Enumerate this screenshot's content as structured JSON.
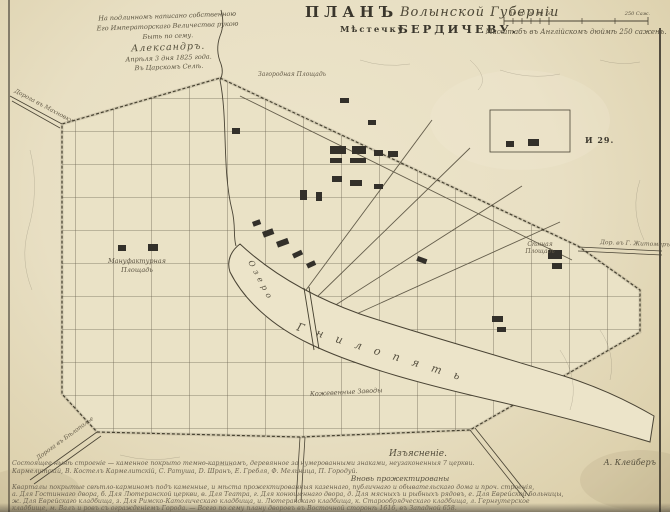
{
  "colors": {
    "paper": "#e8dfc3",
    "ink": "#4a4435",
    "building": "#33302a",
    "faded_ink": "#6b6250"
  },
  "imprimatur": {
    "lines": [
      "На подлинномъ написано собственною",
      "Его Императорскаго Величества рукою",
      "Быть по сему.",
      "Александръ.",
      "Апрѣля 3 дня 1825 года.",
      "Въ Царскомъ Селѣ."
    ]
  },
  "title": {
    "plan_word": "ПЛАНЪ",
    "province_script": "Волынской Губерніи",
    "town_prefix": "Мѣстечку",
    "town_name": "БЕРДИЧЕВУ."
  },
  "scale": {
    "ticks": [
      "10",
      "20",
      "30",
      "40",
      "50"
    ],
    "end_label": "250 Саж.",
    "caption": "Масштабъ въ Англійскомъ дюймѣ 250 саженъ."
  },
  "map_labels": {
    "lake_word": "Озеро",
    "river_name": "Гнилопять",
    "square_manufactory_line1": "Мануфактурная",
    "square_manufactory_line2": "Площадь",
    "square_top": "Загородная Площадь",
    "hay_square_line1": "Сѣнная",
    "hay_square_line2": "Площадь",
    "tanneries": "Кожевенные Заводы",
    "road_zhytomyr": "Дор. въ Г. Житомиръ",
    "road_makhnovka": "Дорога въ Махновку",
    "road_bilopillia": "Дорога въ Бѣлополье",
    "plot_mark": "И 29."
  },
  "legend": {
    "heading": "Изъясненіе.",
    "line1": "Состоящее нынѣ строеніе — каменное покрыто темно-карминомъ, деревянное за нумерованными знаками, неузаконенныя 7 церкви.",
    "signature": "А. Клейберъ",
    "line2": "Кармелитскій, B. Костелъ Кармелитскій, C. Ратуша, D. Шранъ, Е. Гребля, Ф. Мельница, П. Городуй.",
    "subheading": "Вновь прожектированы",
    "line3": "Кварталы покрытые свѣтло-карминомъ подъ каменные, и мѣста прожектированныя казеннаго, публичнаго и обывательскаго дома и проч. строенія,",
    "line4": "а. Для Гостиннаго двора, б. Для Лютеранской церкви, в. Для Театра, г. Для конюшеннаго двора, д. Для мясныхъ и рыбныхъ рядовъ, е. Для Еврейской больницы,",
    "line5": "ж. Для Еврейскаго кладбища, з. Для Римско-Католическаго кладбища, и. Лютеранскаго кладбища, к. Старообрядческаго кладбища, л. Гернгутерское",
    "line6": "кладбище, м. Валъ и ровъ съ огражденіемъ Города. — Всего по сему плану дворовъ въ Восточной сторонѣ 1616, въ Западной 658."
  }
}
